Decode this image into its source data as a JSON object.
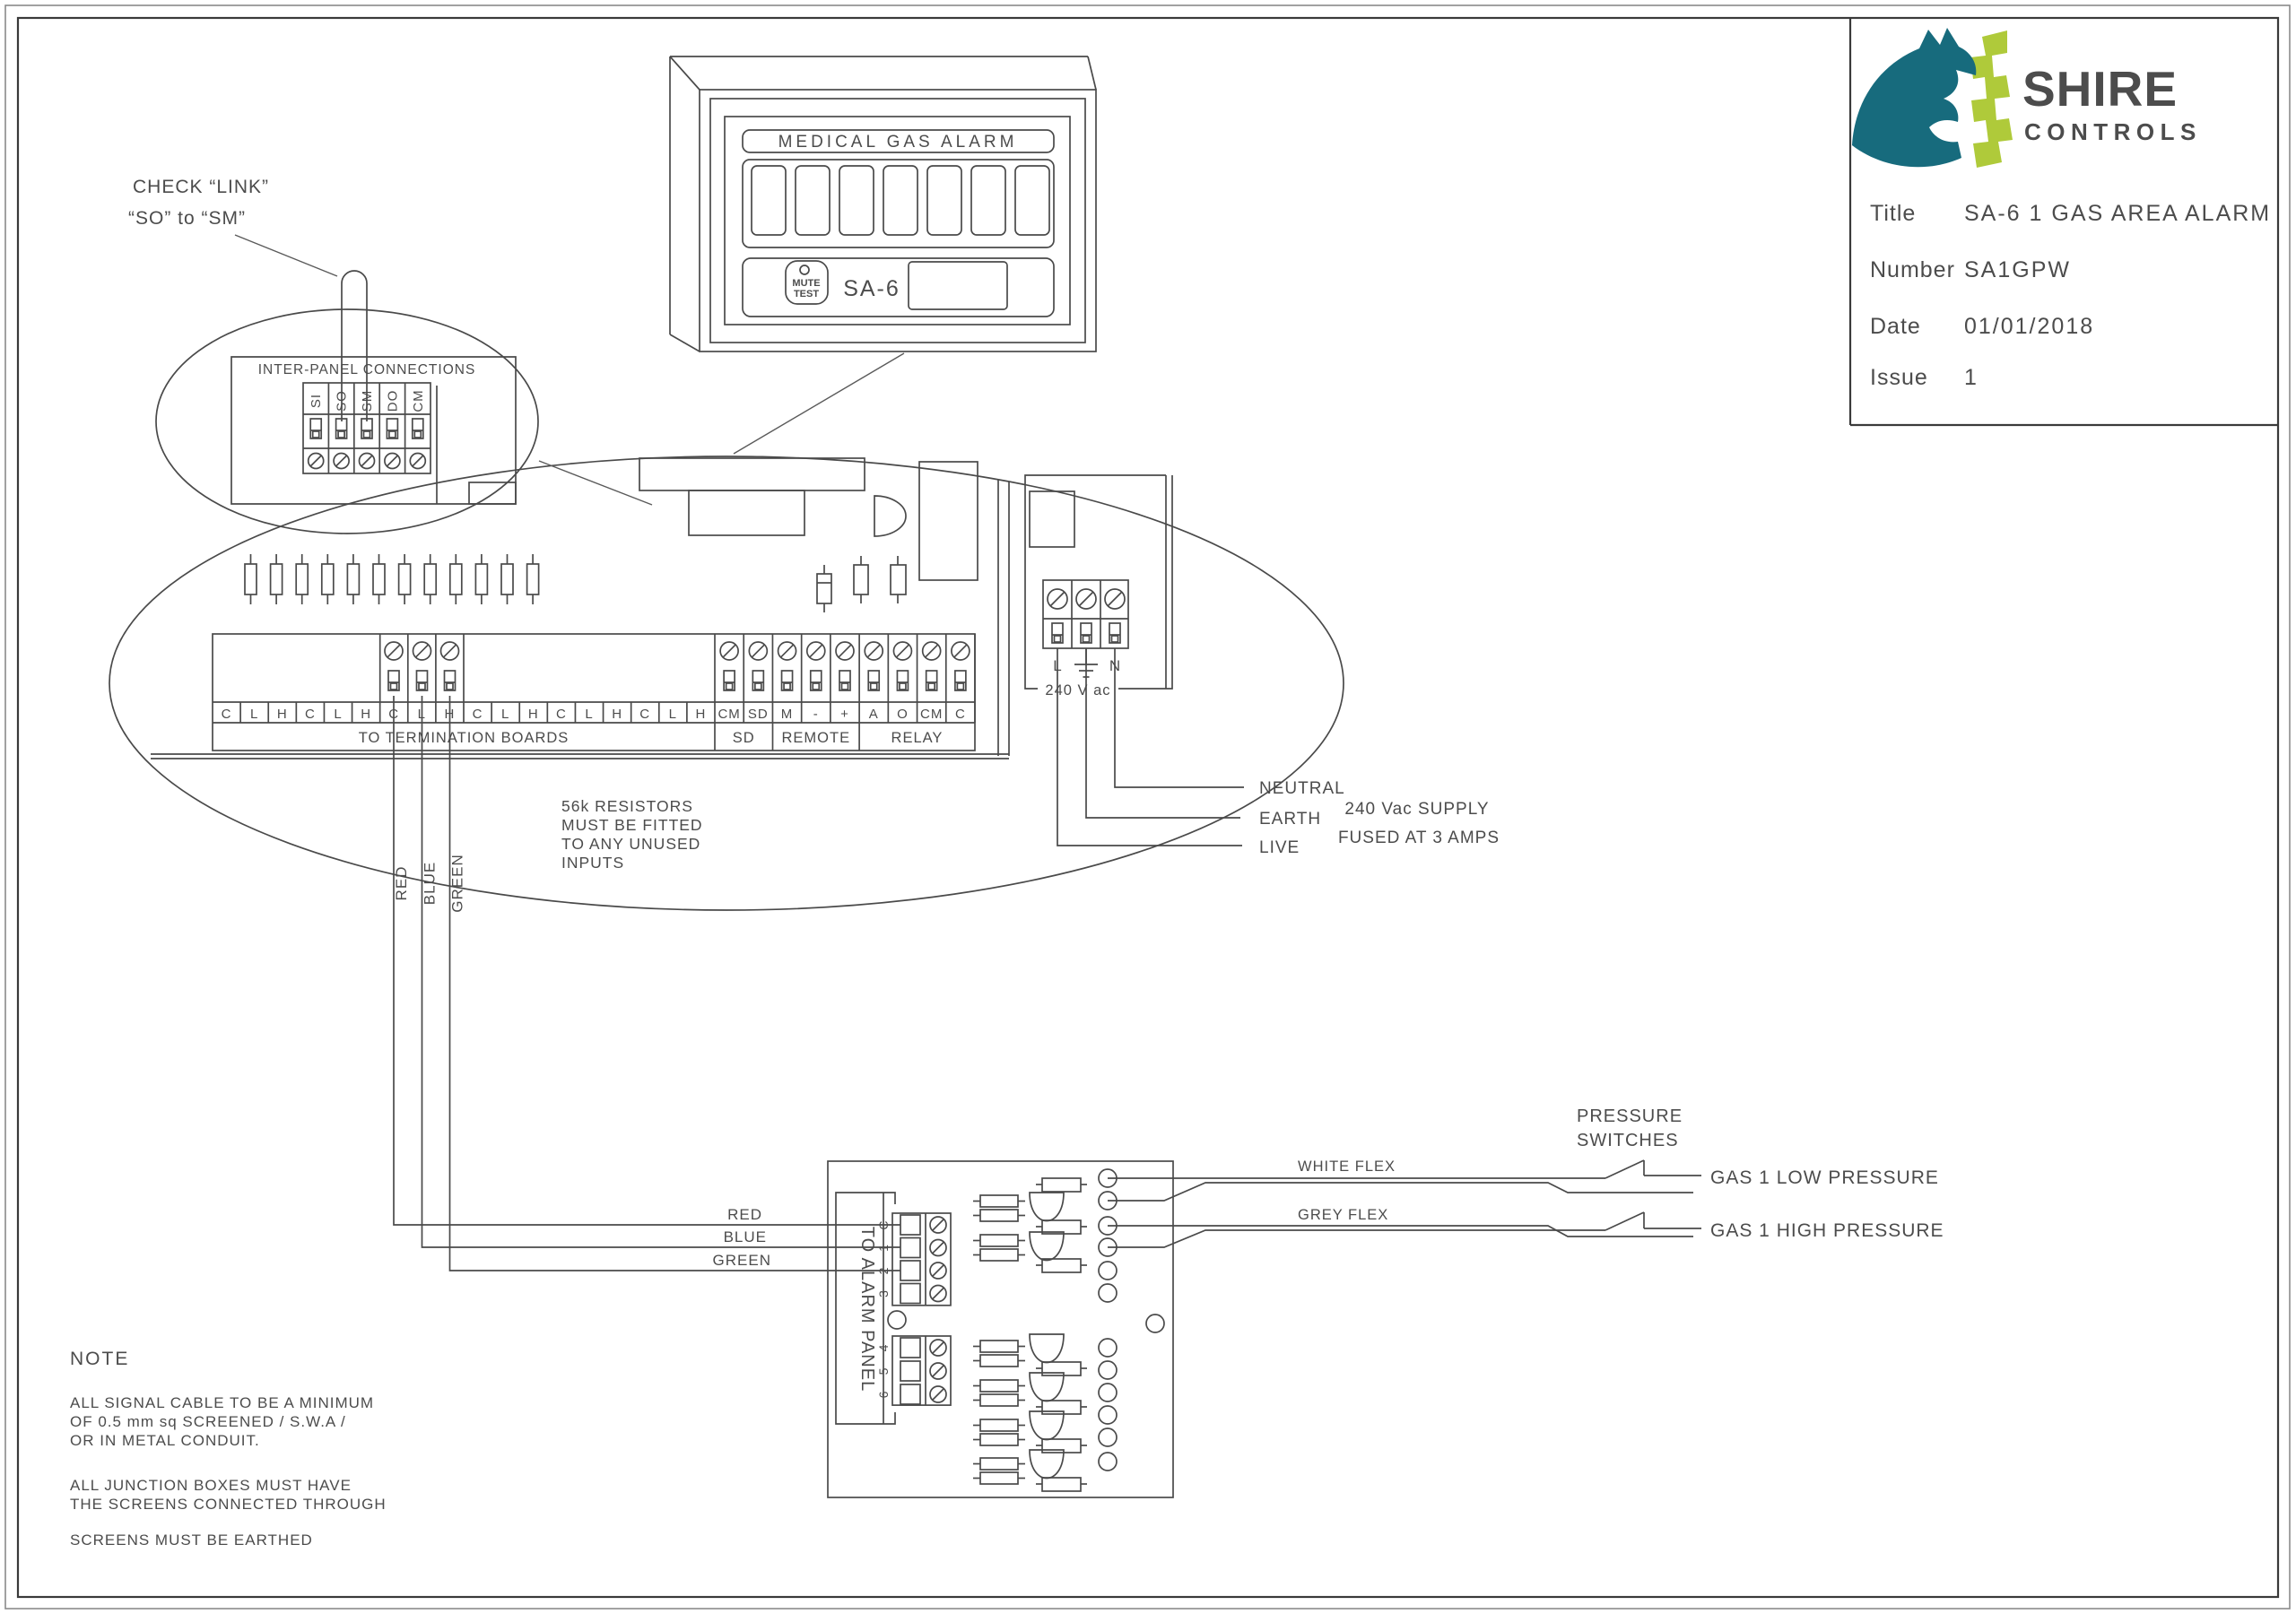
{
  "title_block": {
    "brand_primary": "SHIRE",
    "brand_secondary": "CONTROLS",
    "teal": "#176b7d",
    "lime": "#afca3a",
    "rows": [
      {
        "label": "Title",
        "value": "SA-6 1 GAS AREA ALARM"
      },
      {
        "label": "Number",
        "value": "SA1GPW"
      },
      {
        "label": "Date",
        "value": "01/01/2018"
      },
      {
        "label": "Issue",
        "value": "1"
      }
    ]
  },
  "alarm_panel": {
    "header": "MEDICAL GAS ALARM",
    "mute_line1": "MUTE",
    "mute_line2": "TEST",
    "model": "SA-6",
    "window_count": 7
  },
  "callout": {
    "line1": "CHECK “LINK”",
    "line2": "“SO” to “SM”",
    "title": "INTER-PANEL CONNECTIONS",
    "terminals": [
      "SI",
      "SO",
      "SM",
      "DO",
      "CM"
    ]
  },
  "pcb": {
    "termination_cells": [
      "C",
      "L",
      "H",
      "C",
      "L",
      "H",
      "C",
      "L",
      "H",
      "C",
      "L",
      "H",
      "C",
      "L",
      "H",
      "C",
      "L",
      "H"
    ],
    "termination_label": "TO TERMINATION BOARDS",
    "io_cells": [
      "CM",
      "SD",
      "M",
      "-",
      "+",
      "A",
      "O",
      "CM",
      "C"
    ],
    "io_groups": [
      "SD",
      "REMOTE",
      "RELAY"
    ],
    "resistor_note": [
      "56k RESISTORS",
      "MUST BE FITTED",
      "TO ANY UNUSED",
      "INPUTS"
    ],
    "wire_labels": [
      "RED",
      "BLUE",
      "GREEN"
    ]
  },
  "power": {
    "terminal_l": "L",
    "terminal_n": "N",
    "voltage": "240 V ac",
    "neutral": "NEUTRAL",
    "earth": "EARTH",
    "live": "LIVE",
    "supply_line1": "240 Vac SUPPLY",
    "supply_line2": "FUSED AT 3 AMPS"
  },
  "junction_box": {
    "label": "TO ALARM PANEL",
    "terminals_top": [
      "C",
      "1",
      "2",
      "3"
    ],
    "terminals_bottom": [
      "4",
      "5",
      "6"
    ],
    "wire_labels": [
      "RED",
      "BLUE",
      "GREEN"
    ],
    "white_flex": "WHITE FLEX",
    "grey_flex": "GREY FLEX"
  },
  "switches": {
    "heading_line1": "PRESSURE",
    "heading_line2": "SWITCHES",
    "low": "GAS 1 LOW PRESSURE",
    "high": "GAS 1 HIGH PRESSURE"
  },
  "note": {
    "heading": "NOTE",
    "lines": [
      "ALL SIGNAL CABLE TO BE A MINIMUM",
      "OF 0.5 mm sq SCREENED / S.W.A /",
      "OR IN METAL CONDUIT.",
      "ALL JUNCTION BOXES MUST HAVE",
      "THE SCREENS CONNECTED THROUGH",
      "SCREENS MUST BE EARTHED"
    ]
  }
}
